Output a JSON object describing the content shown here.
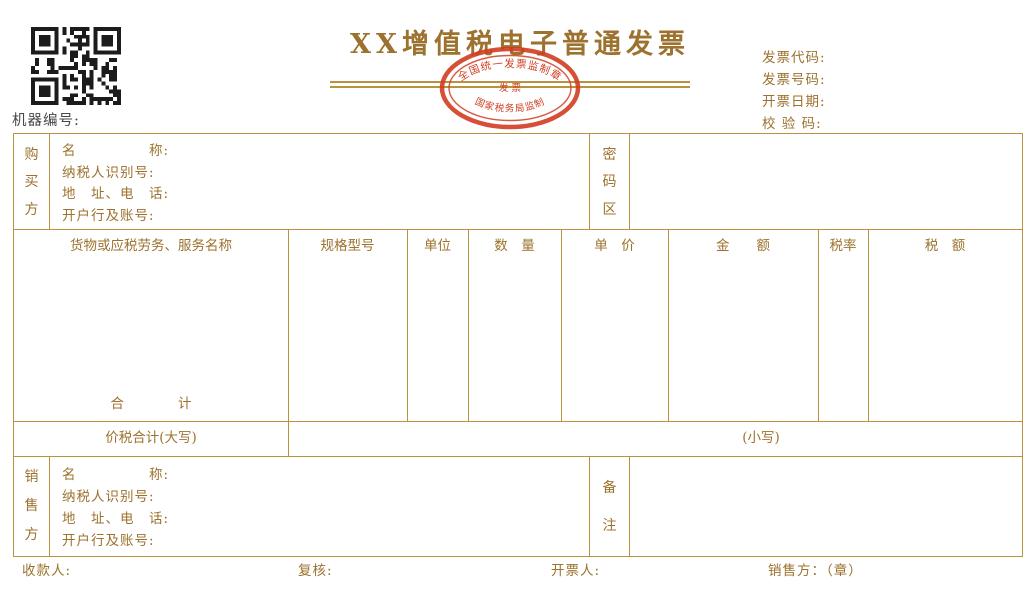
{
  "colors": {
    "gold": "#9c722e",
    "line": "#b9923e",
    "dark": "#474747",
    "stamp": "#d13c20",
    "qr": "#1c1c1c"
  },
  "header": {
    "title": "XX增值税电子普通发票",
    "machine_label": "机器编号:",
    "meta_labels": [
      "发票代码:",
      "发票号码:",
      "开票日期:",
      "校 验 码:"
    ],
    "stamp": {
      "top_text": "全国统一发票监制章",
      "center_text": "发 票",
      "bottom_text": "国家税务局监制"
    }
  },
  "buyer": {
    "side": [
      "购",
      "买",
      "方"
    ],
    "fields": [
      "名　　　　　称:",
      "纳税人识别号:",
      "地　址、电　话:",
      "开户行及账号:"
    ],
    "password": [
      "密",
      "码",
      "区"
    ]
  },
  "items": {
    "columns": [
      "货物或应税劳务、服务名称",
      "规格型号",
      "单位",
      "数　量",
      "单　价",
      "金　　额",
      "税率",
      "税　额"
    ],
    "total": "合　　　　计"
  },
  "totals": {
    "in_words": "价税合计(大写)",
    "in_figures": "(小写)"
  },
  "seller": {
    "side": [
      "销",
      "售",
      "方"
    ],
    "fields": [
      "名　　　　　称:",
      "纳税人识别号:",
      "地　址、电　话:",
      "开户行及账号:"
    ],
    "remark": [
      "备",
      "注"
    ]
  },
  "footer": {
    "payee": "收款人:",
    "checker": "复核:",
    "drawer": "开票人:",
    "seller_seal": "销售方：（章）"
  }
}
